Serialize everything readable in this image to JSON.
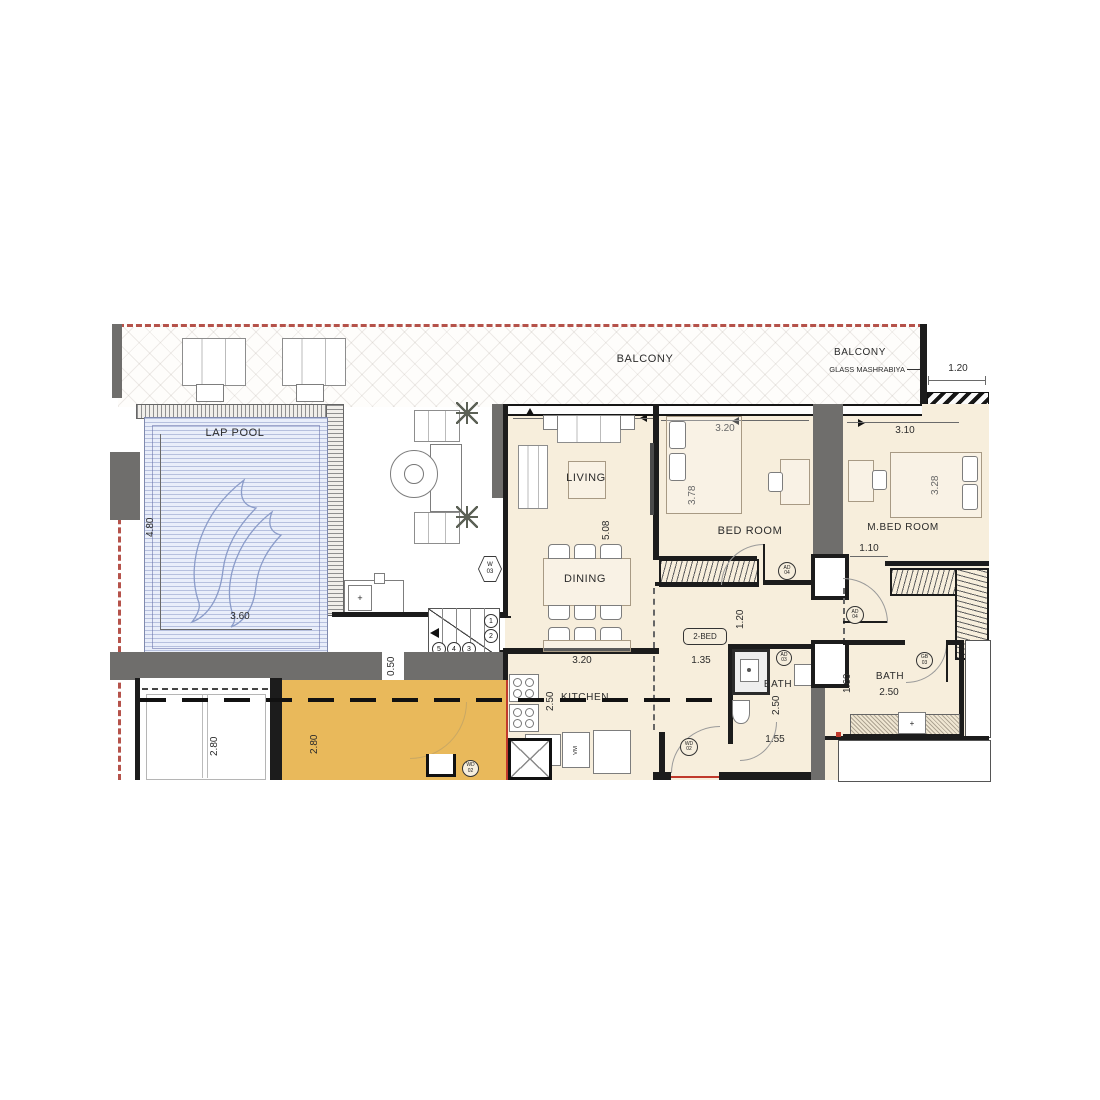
{
  "labels": {
    "balcony_left": "BALCONY",
    "balcony_right": "BALCONY",
    "glass_mashrabiya": "GLASS MASHRABIYA",
    "lap_pool": "LAP POOL",
    "living": "LIVING",
    "dining": "DINING",
    "bedroom": "BED ROOM",
    "master_bedroom": "M.BED ROOM",
    "kitchen": "KITCHEN",
    "bath_mid": "BATH",
    "bath_master": "BATH",
    "unit_type": "2-BED"
  },
  "dimensions": {
    "balcony_depth": "1.20",
    "pool_length": "4.80",
    "pool_width": "3.60",
    "living_width": "3.20",
    "living_length": "5.08",
    "bedroom_width": "3.20",
    "bedroom_length": "3.78",
    "master_width": "3.10",
    "master_length": "3.28",
    "master_closet": "1.10",
    "hall_width": "1.20",
    "hall_opening": "1.35",
    "kitchen_width": "3.20",
    "kitchen_depth": "2.50",
    "bath_mid_depth": "2.50",
    "bath_mid_width": "1.55",
    "bath_master_width": "2.50",
    "bath_master_depth": "1.60",
    "lower_room_left": "2.80",
    "lower_room_right": "2.80",
    "wall_offset": "0.50"
  },
  "tags": {
    "window": {
      "line1": "W",
      "line2": "03"
    },
    "bedroom_door": {
      "line1": "AD",
      "line2": "04"
    },
    "master_door": {
      "line1": "AD",
      "line2": "04"
    },
    "bath_mid_door": {
      "line1": "AD",
      "line2": "03"
    },
    "bath_master_door": {
      "line1": "GB",
      "line2": "03"
    },
    "entry_door": {
      "line1": "WD",
      "line2": "02"
    },
    "lower_room_door": {
      "line1": "WD",
      "line2": "02"
    }
  },
  "stairs": {
    "steps": [
      "1",
      "2",
      "3",
      "4",
      "5"
    ]
  },
  "fixtures": {
    "sink_mark": "+",
    "washer": "VM"
  },
  "colors": {
    "floor": "#f7eedc",
    "wall_gray": "#6f6e6c",
    "wall_black": "#1c1c1c",
    "pool_water": "#e9eefa",
    "accent_room": "#e9b95b",
    "boundary_red": "#b5524a"
  }
}
